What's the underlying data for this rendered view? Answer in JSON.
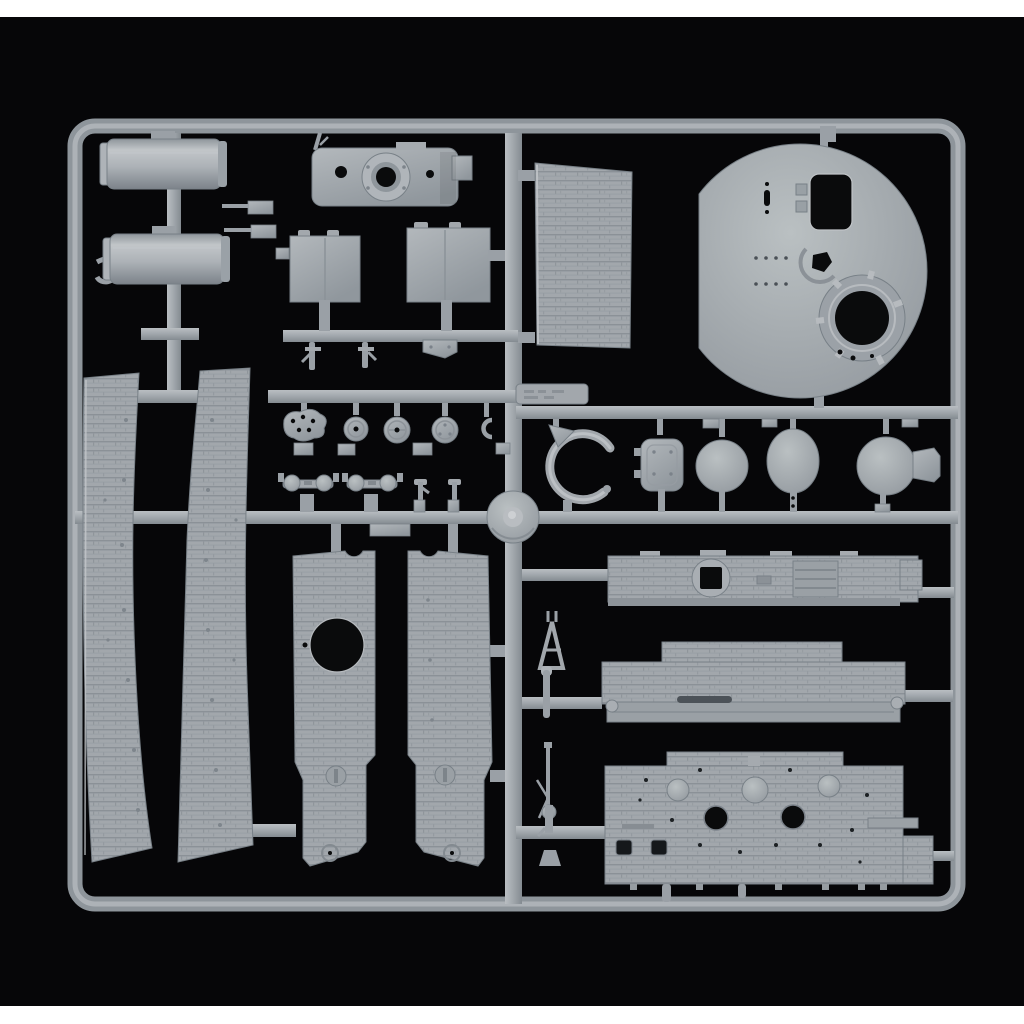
{
  "photo": {
    "alt": "Product photo of a gray injection-molded plastic model kit sprue (parts tree) for a military tank kit, lying on a black background with thin white strips at the top and bottom of the square image",
    "caption": ""
  },
  "colors": {
    "page-bg": "#ffffff",
    "photo-bg": "#060608",
    "sprue": "#9aa0a6",
    "sprue-light": "#b9bec2",
    "sprue-mid": "#a3a9ae",
    "sprue-dark": "#848b91",
    "edge": "#788087",
    "hole": "#0a0b0c"
  },
  "parts": [
    {
      "id": "exhaust-muffler-1",
      "shape": "cylinder"
    },
    {
      "id": "exhaust-muffler-2",
      "shape": "cylinder"
    },
    {
      "id": "turret-base-with-gun-ring",
      "shape": "plate with circular ring"
    },
    {
      "id": "stowage-box-left",
      "shape": "rectangular box"
    },
    {
      "id": "stowage-box-right",
      "shape": "rectangular box"
    },
    {
      "id": "zimmerit-armour-panel",
      "shape": "textured rectangle"
    },
    {
      "id": "turret-roof-disc",
      "shape": "large round plate with hatch opening and cupola ring"
    },
    {
      "id": "wheel-hub-cluster",
      "shape": "row of small round hubs"
    },
    {
      "id": "hatch-rounded-rect",
      "shape": "rounded rectangular hatch"
    },
    {
      "id": "hatch-round-1",
      "shape": "round hatch"
    },
    {
      "id": "hatch-round-2",
      "shape": "round hatch"
    },
    {
      "id": "hatch-round-with-tab",
      "shape": "round hatch with side lug"
    },
    {
      "id": "tow-cable-hook",
      "shape": "curved arm"
    },
    {
      "id": "track-tensioner-1",
      "shape": "twin-dome clamp"
    },
    {
      "id": "track-tensioner-2",
      "shape": "twin-dome clamp"
    },
    {
      "id": "cupola-cone-disc",
      "shape": "cone-topped disc"
    },
    {
      "id": "side-skirt-panel-left",
      "shape": "long tapered zimmerit panel"
    },
    {
      "id": "side-skirt-panel-right",
      "shape": "long tapered zimmerit panel"
    },
    {
      "id": "turret-side-panel-left",
      "shape": "zimmerit panel with round opening"
    },
    {
      "id": "turret-side-panel-right",
      "shape": "zimmerit panel"
    },
    {
      "id": "hull-top-plate",
      "shape": "long plate with ring and grille"
    },
    {
      "id": "engine-deck-plate",
      "shape": "stepped zimmerit deck"
    },
    {
      "id": "hull-rear-plate",
      "shape": "wide zimmerit plate with domes and holes"
    },
    {
      "id": "jack-base",
      "shape": "triangular bracket"
    },
    {
      "id": "smoke-launcher-rod",
      "shape": "short rod"
    },
    {
      "id": "machine-gun",
      "shape": "MG with drum magazine and bipod"
    },
    {
      "id": "mould-id-tag",
      "shape": "small embossed tag"
    }
  ]
}
